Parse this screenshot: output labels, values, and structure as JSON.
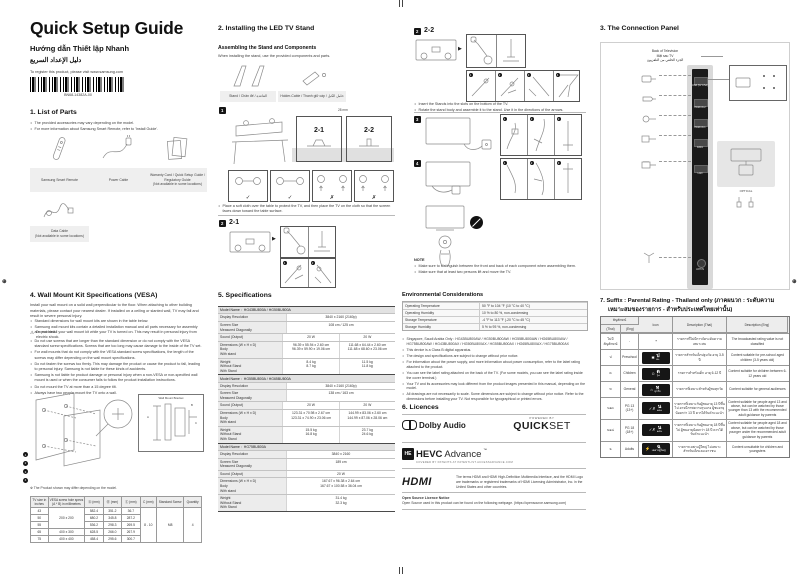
{
  "header": {
    "title": "Quick Setup Guide",
    "subtitle_vi": "Hướng dẫn Thiết lập Nhanh",
    "subtitle_ar": "دليل الإعداد السريع",
    "register_note": "To register this product, please visit www.samsung.com",
    "barcode_label": "BN68-14382A-00"
  },
  "parts": {
    "heading": "1. List of Parts",
    "bullets": [
      "The provided accessories may vary depending on the model.",
      "For more information about Samsung Smart Remote, refer to 'Install Guide'."
    ],
    "items": [
      {
        "label": "Samsung Smart Remote"
      },
      {
        "label": "Power Cable"
      },
      {
        "label": "Warranty Card / Quick Setup Guide /\nRegulatory Guide\n(Not available in some locations)"
      },
      {
        "label": "Data Cable\n(Not available in some locations)"
      }
    ]
  },
  "stand": {
    "heading": "2. Installing the LED TV Stand",
    "subheading": "Assembling the Stand and Components",
    "desc": "When installing the stand, use the provided components and parts.",
    "component_labels": [
      "Stand / Chân đế / القاعدة",
      "Holder-Cable / Thanh giữ cáp / حامل الكبل"
    ],
    "step1_num": "1",
    "variant_21": "2-1",
    "variant_22": "2-2",
    "dim_label": "28 mm",
    "check_marks": [
      "✓",
      "✓",
      "✗",
      "✗"
    ],
    "cloth_note": "Place a soft cloth over the table to protect the TV, and then place the TV on the cloth so that the screen faces down toward the table surface.",
    "step2_num": "2",
    "step2_label": "2-1",
    "step3_num": "2",
    "step3_label": "2-2",
    "substep_nums": [
      "1",
      "2",
      "3",
      "4"
    ],
    "assemble_bullets": [
      "Insert the Stands into the slots on the bottom of the TV.",
      "Rotate the stand body and assemble it to the stand. Use it in the directions of the arrows."
    ],
    "stepA_num": "3",
    "stepB_num": "4",
    "note_title": "NOTE",
    "notes": [
      "Make sure to distinguish between the front and back of each component when assembling them.",
      "Make sure that at least two persons lift and move the TV."
    ]
  },
  "connection": {
    "heading": "3. The Connection Panel",
    "back_label": "Back of Television\nMặt sau TV\nالجزء الخلفي من التلفزيون",
    "ports": [
      "USB (5V 0.5A)",
      "HDMI IN 2",
      "HDMI IN 1",
      "DATA",
      "LAN",
      "ANT IN"
    ],
    "optical_label": "OPTICAL"
  },
  "vesa": {
    "heading": "4. Wall Mount Kit Specifications (VESA)",
    "intro": "Install your wall mount on a solid wall perpendicular to the floor. When attaching to other building materials, please contact your nearest dealer. If installed on a ceiling or slanted wall, TV may fall and result in severe personal injury.",
    "bullets_top": [
      "Standard dimensions for wall mount kits are shown in the table below.",
      "Samsung wall mount kits contain a detailed installation manual and all parts necessary for assembly are provided."
    ],
    "warning": "Do not install your wall mount kit while your TV is turned on. This may result in personal injury from electric shock.",
    "bullets": [
      "Do not use screws that are longer than the standard dimension or do not comply with the VESA standard screw specifications. Screws that are too long may cause damage to the inside of the TV set.",
      "For wall mounts that do not comply with the VESA standard screw specifications, the length of the screws may differ depending on the wall mount specifications.",
      "Do not fasten the screws too firmly. This may damage the product or cause the product to fall, leading to personal injury. Samsung is not liable for these kinds of accidents.",
      "Samsung is not liable for product damage or personal injury when a non-VESA or non-specified wall mount is used or when the consumer fails to follow the product installation instructions.",
      "Do not mount the TV at more than a 15 degree tilt.",
      "Always have two people mount the TV onto a wall."
    ],
    "fig_callouts": [
      "1",
      "2",
      "3",
      "4"
    ],
    "fig_bracket_label": "Wall Mount Bracket",
    "fig_dims": [
      "A",
      "B",
      "C"
    ],
    "fig_caption": "※ The Product shown may differ depending on the model.",
    "table": {
      "headers": [
        "TV size in inches",
        "VESA screw hole specs (A * B) in millimetres",
        "Ⓐ (mm)",
        "Ⓑ (mm)",
        "Ⓒ (mm)",
        "C (mm)",
        "Standard Screw",
        "Quantity"
      ],
      "rows": [
        {
          "size": "43",
          "a": "582.4",
          "b": "351.2",
          "c": "36.7"
        },
        {
          "size": "50",
          "a": "680.2",
          "b": "345.8",
          "c": "287.2"
        },
        {
          "size": "55",
          "a": "536.2",
          "b": "298.3",
          "c": "269.5"
        },
        {
          "size": "65",
          "a": "628.5",
          "b": "266.0",
          "c": "267.9"
        },
        {
          "size": "75",
          "a": "458.4",
          "b": "295.6",
          "c": "300.7"
        }
      ],
      "vesa_43_55": "200 x 200",
      "vesa_65": "400 x 300",
      "vesa_75": "400 x 400",
      "c_mm": "8 - 10",
      "screw": "M8",
      "quantity": "4"
    }
  },
  "specs": {
    "heading": "5. Specifications",
    "labels": {
      "model": "Model Name :",
      "resolution": "Display Resolution",
      "screen": "Screen Size\nMeasured Diagonally",
      "sound": "Sound (Output)",
      "dims": "Dimensions (W x H x D)\nBody\nWith stand",
      "weight": "Weight\nWithout Stand\nWith Stand"
    },
    "blocks": [
      {
        "model": "HG43BU800A / HG50BU800A",
        "resolution": "3840 x 2160 (2160p)",
        "screen": "108 cm / 125 cm",
        "sound1": "20 W",
        "sound2": "20 W",
        "dims1": "96.39 x 55.94 x 2.60 cm\n96.39 x 59.90 x 19.06 cm",
        "dims2": "111.68 x 64.44 x 2.60 cm\n111.68 x 68.60 x 23.06 cm",
        "weight1": "8.4 kg\n8.7 kg",
        "weight2": "11.5 kg\n11.8 kg"
      },
      {
        "model": "HG55BU800A / HG65BU800A",
        "resolution": "3840 x 2160 (2160p)",
        "screen": "138 cm / 163 cm",
        "sound1": "20 W",
        "sound2": "20 W",
        "dims1": "123.31 x 70.98 x 2.67 cm\n123.31 x 74.90 x 23.06 cm",
        "dims2": "144.99 x 83.06 x 2.60 cm\n144.99 x 87.06 x 28.06 cm",
        "weight1": "15.5 kg\n16.8 kg",
        "weight2": "23.7 kg\n24.6 kg"
      },
      {
        "model": "HG75BU800A",
        "resolution": "3840 x 2160",
        "screen": "189 cm",
        "sound1": "20 W",
        "dims1": "167.67 x 96.38 x 2.64 cm\n167.67 x 100.58 x 36.04 cm",
        "weight1": "31.4 kg\n32.3 kg"
      }
    ]
  },
  "environment": {
    "heading": "Environmental Considerations",
    "rows": [
      {
        "label": "Operating Temperature",
        "value": "50 °F to 104 °F (10 °C to 40 °C)"
      },
      {
        "label": "Operating Humidity",
        "value": "10 % to 80 %, non-condensing"
      },
      {
        "label": "Storage Temperature",
        "value": "-4 °F to 113 °F (-20 °C to 45 °C)"
      },
      {
        "label": "Storage Humidity",
        "value": "5 % to 95 %, non-condensing"
      }
    ],
    "bullets": [
      "Singapore, Saudi Arabia Only : HG43BU800AW / HG50BU800AW / HG55BU800AW / HG65BU800AW / HG75BU800AW / HG43BU800AX / HG50BU800AX / HG55BU800AX / HG65BU800AX / HG75BU800AX",
      "This device is a Class B digital apparatus.",
      "The design and specifications are subject to change without prior notice.",
      "For information about the power supply, and more information about power consumption, refer to the label rating attached to the product.",
      "You can see the label rating attached on the back of the TV. (For some models, you can see the label rating inside the cover terminal.)",
      "Your TV and its accessories may look different from the product images presented in this manual, depending on the model.",
      "All drawings are not necessarily to scale. Some dimensions are subject to change without prior notice. Refer to the dimensions before installing your TV. Not responsible for typographical or printed errors."
    ]
  },
  "licences": {
    "heading": "6. Licences",
    "dolby_label": "Dolby Audio",
    "quickset_powered": "POWERED BY",
    "quickset_q": "QUICK",
    "quickset_s": "SET",
    "hevc_badge": "HE",
    "hevc_bold": "HEVC",
    "hevc_light": "Advance",
    "hevc_tm": "™",
    "hevc_sub": "COVERED BY PATENTS AT PATENTLIST.ACCESSADVANCE.COM",
    "hdmi_label": "HDMI",
    "hdmi_text": "The terms HDMI and HDMI High-Definition Multimedia Interface, and the HDMI Logo are trademarks or registered trademarks of HDMI Licensing Administrator, Inc. in the United States and other countries.",
    "oss_title": "Open Source Licence Notice",
    "oss_text": "Open Source used in this product can be found on the following webpage. (https://opensource.samsung.com)"
  },
  "rating": {
    "heading_l1": "7. Suffix : Parental Rating - Thailand only (ภาคผนวก : ระดับความ",
    "heading_l2": "เหมาะสมของรายการ - สำหรับประเทศไทยเท่านั้น)",
    "headers": {
      "symbol": "สัญลักษณ์",
      "thai": "(Thai)",
      "eng": "(Eng)",
      "icon": "Icon",
      "desc_thai": "Description (Thai)",
      "desc_eng": "Description (Eng)"
    },
    "rows": [
      {
        "thai": "ไม่มีสัญลักษณ์",
        "eng": "-",
        "glyph": "",
        "letter": "-",
        "age": "",
        "desc_thai": "รายการที่ไม่มีการจัดระดับความเหมาะสม",
        "desc_eng": "The broadcasted rating value is not classified"
      },
      {
        "thai": "ป",
        "eng": "Preschool",
        "glyph": "✱",
        "letter": "ป",
        "age": "๓+",
        "desc_thai": "รายการสำหรับเด็กปฐมวัย อายุ 3-5 ปี",
        "desc_eng": "Content suitable for pre-school aged children (3-5 years old)"
      },
      {
        "thai": "ด",
        "eng": "Children",
        "glyph": "☺",
        "letter": "ด",
        "age": "๖+",
        "desc_thai": "รายการสำหรับเด็ก อายุ 6-12 ปี",
        "desc_eng": "Content suitable for children between 6-12 years old"
      },
      {
        "thai": "ท",
        "eng": "General",
        "glyph": "⌂",
        "letter": "ท",
        "age": "ทุกวัย",
        "desc_thai": "รายการที่เหมาะสำหรับผู้ชมทุกวัย",
        "desc_eng": "Content suitable for general audiences"
      },
      {
        "thai": "น๑๓",
        "eng": "PG 13\n(13+)",
        "glyph": "✓✗",
        "letter": "น",
        "age": "๑๓+",
        "desc_thai": "รายการที่เหมาะกับผู้ชมอายุ 13 ปีขึ้นไป อาจมีภาพความรุนแรง ผู้ชมอายุน้อยกว่า 13 ปี ควรได้รับคำแนะนำ",
        "desc_eng": "Content suitable for people aged 13 and above, but can be watched by those younger than 13 with the recommended adult guidance by parents"
      },
      {
        "thai": "น๑๘",
        "eng": "PG 18\n(18+)",
        "glyph": "✓✗",
        "letter": "น",
        "age": "๑๘+",
        "desc_thai": "รายการที่เหมาะกับผู้ชมอายุ 18 ปีขึ้นไป ผู้ชมอายุน้อยกว่า 18 ปี ควรได้รับคำแนะนำ",
        "desc_eng": "Content suitable for people aged 18 and above, but can be watched by those younger under the recommended adult guidance by parents"
      },
      {
        "thai": "ฉ",
        "eng": "Adults",
        "glyph": "⚡",
        "letter": "ฉ",
        "age": "เฉพาะผู้ใหญ่",
        "desc_thai": "รายการเฉพาะผู้ใหญ่ ไม่เหมาะสำหรับเด็กและเยาวชน",
        "desc_eng": "Content unsuitable for children and youngsters"
      }
    ]
  }
}
